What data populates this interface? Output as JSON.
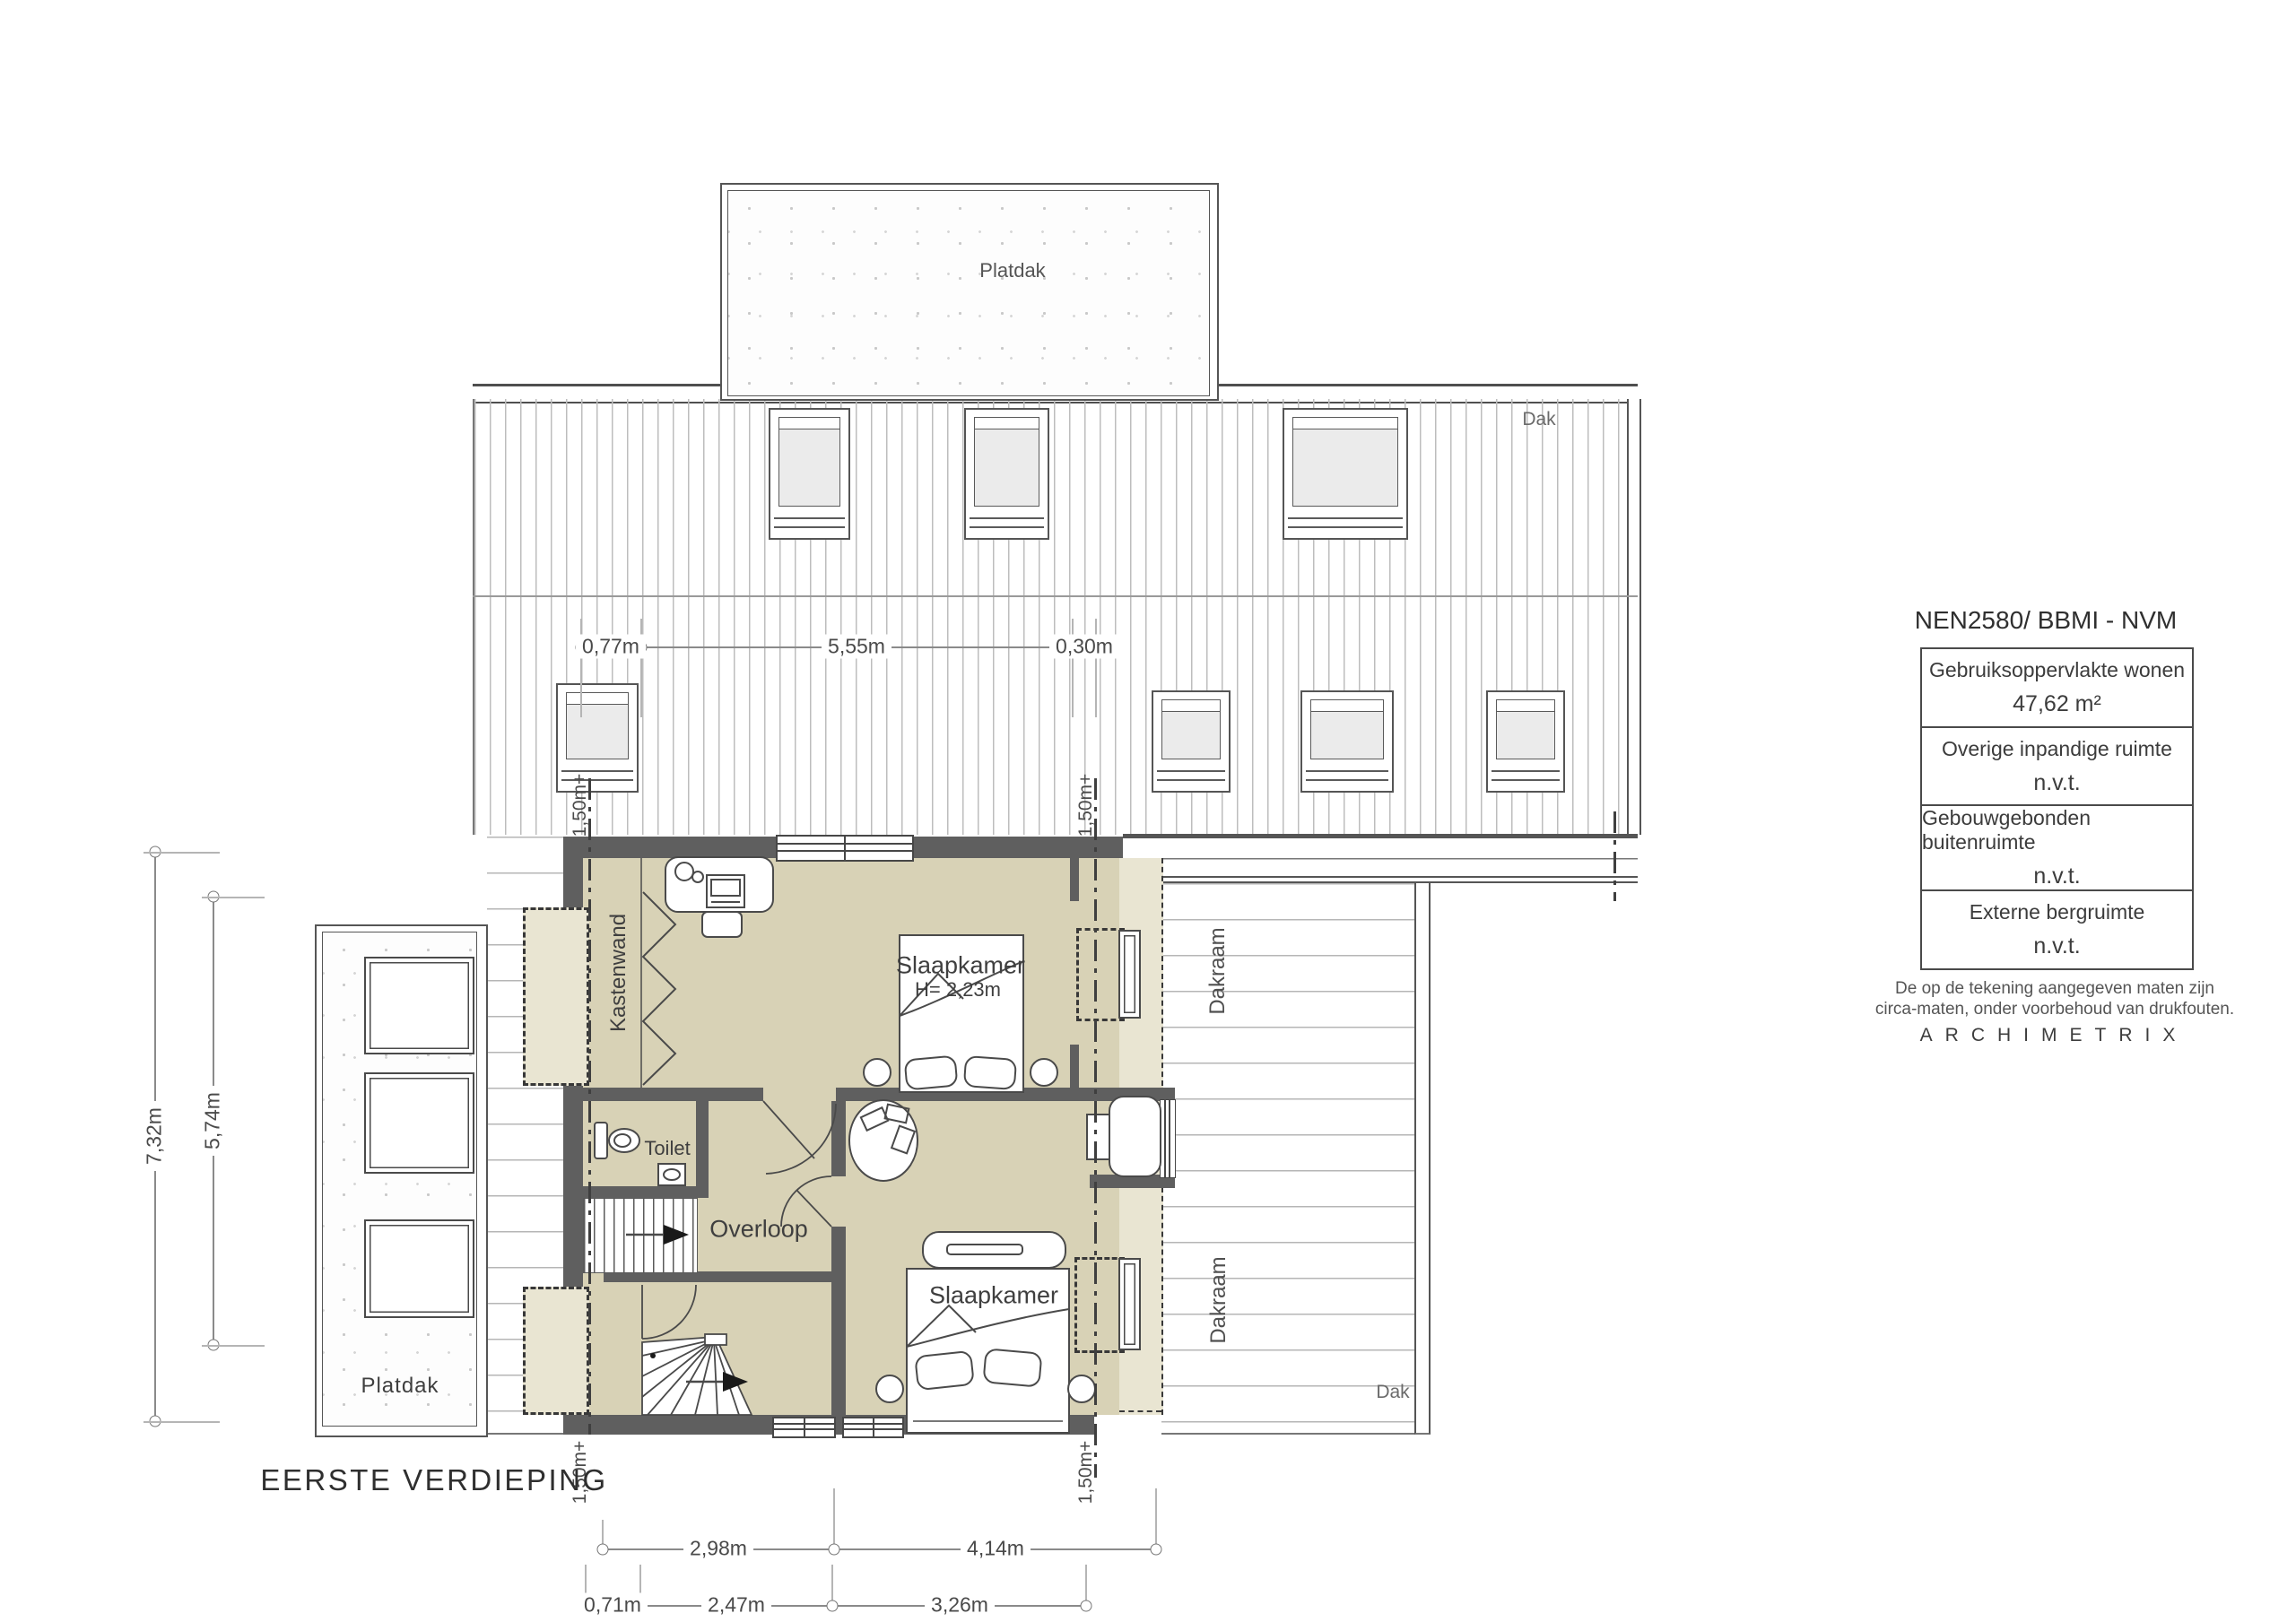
{
  "plan": {
    "floor_title": "EERSTE VERDIEPING",
    "labels": {
      "platdak_top": "Platdak",
      "dak_roof": "Dak",
      "dak_lower": "Dak",
      "kastenwand": "Kastenwand",
      "bedroom1": "Slaapkamer",
      "bedroom1_height": "H= 2,23m",
      "toilet": "Toilet",
      "overloop": "Overloop",
      "bedroom2": "Slaapkamer",
      "dakraam_upper": "Dakraam",
      "dakraam_lower": "Dakraam",
      "platdak_left": "Platdak"
    },
    "level_marker": "1,50m+",
    "dimensions": {
      "top": [
        "0,77m",
        "5,55m",
        "0,30m"
      ],
      "left": [
        "7,32m",
        "5,74m"
      ],
      "bottom_row1": [
        "2,98m",
        "4,14m"
      ],
      "bottom_row2": [
        "0,71m",
        "2,47m",
        "3,26m"
      ]
    }
  },
  "legend": {
    "title": "NEN2580/ BBMI - NVM",
    "rows": [
      {
        "label": "Gebruiksoppervlakte wonen",
        "value": "47,62 m²"
      },
      {
        "label": "Overige inpandige ruimte",
        "value": "n.v.t."
      },
      {
        "label": "Gebouwgebonden buitenruimte",
        "value": "n.v.t."
      },
      {
        "label": "Externe bergruimte",
        "value": "n.v.t."
      }
    ],
    "note_line1": "De op de tekening aangegeven maten zijn",
    "note_line2": "circa-maten, onder voorbehoud van drukfouten.",
    "brand": "ARCHIMETRIX"
  },
  "colors": {
    "room_fill": "#d8d2b6",
    "under_roof_fill": "#e9e5d2",
    "wall": "#5f5f5f",
    "line": "#4a4a4a",
    "hatch": "#bdbdbd"
  }
}
